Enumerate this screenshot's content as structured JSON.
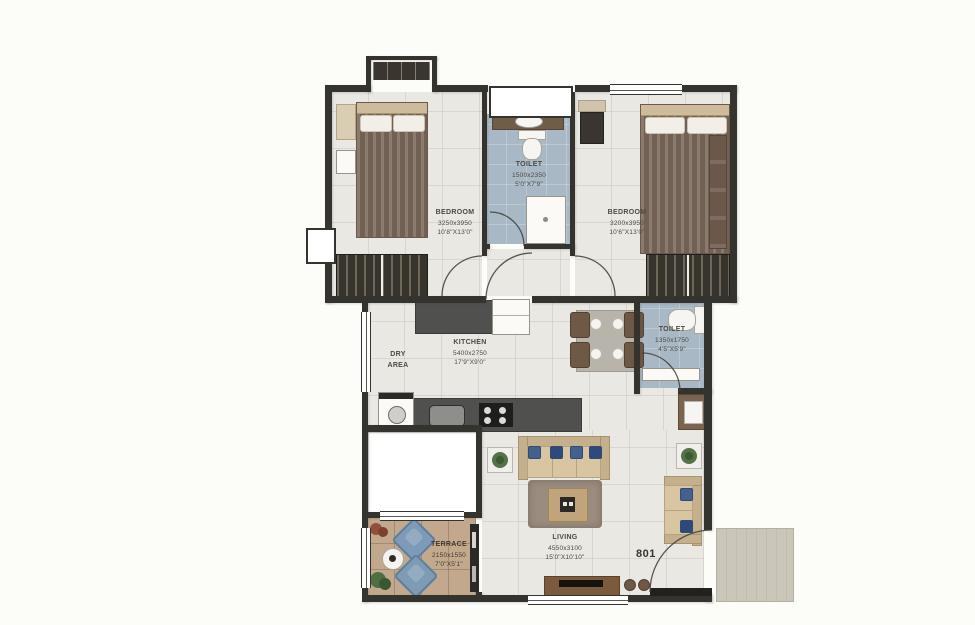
{
  "meta": {
    "unit_number": "801",
    "plan_type": "2 BHK floor plan with terrace"
  },
  "rooms": [
    {
      "id": "bedroom-left",
      "name": "BEDROOM",
      "dims_mm": "3250x3950",
      "dims_ft": "10'8\"X13'0\""
    },
    {
      "id": "toilet-top",
      "name": "TOILET",
      "dims_mm": "1500x2350",
      "dims_ft": "5'0\"X7'9\""
    },
    {
      "id": "bedroom-right",
      "name": "BEDROOM",
      "dims_mm": "3200x3950",
      "dims_ft": "10'6\"X13'0\""
    },
    {
      "id": "kitchen",
      "name": "KITCHEN",
      "dims_mm": "5400x2750",
      "dims_ft": "17'9\"X9'0\""
    },
    {
      "id": "dry-area",
      "name": "DRY AREA",
      "dims_mm": "",
      "dims_ft": ""
    },
    {
      "id": "toilet-right",
      "name": "TOILET",
      "dims_mm": "1350x1750",
      "dims_ft": "4'5\"X5'9\""
    },
    {
      "id": "living",
      "name": "LIVING",
      "dims_mm": "4550x3100",
      "dims_ft": "15'0\"X10'10\""
    },
    {
      "id": "terrace",
      "name": "TERRACE",
      "dims_mm": "2150x1550",
      "dims_ft": "7'0\"X5'1\""
    }
  ],
  "colors": {
    "wall": "#35332d",
    "floor_tile": "#e9e8e3",
    "toilet_floor": "#a8b9c5",
    "terrace_floor": "#c2a98e",
    "landing": "#cac6b9",
    "accent_blue": "#7d9bb6",
    "label_text": "#4c4940"
  }
}
